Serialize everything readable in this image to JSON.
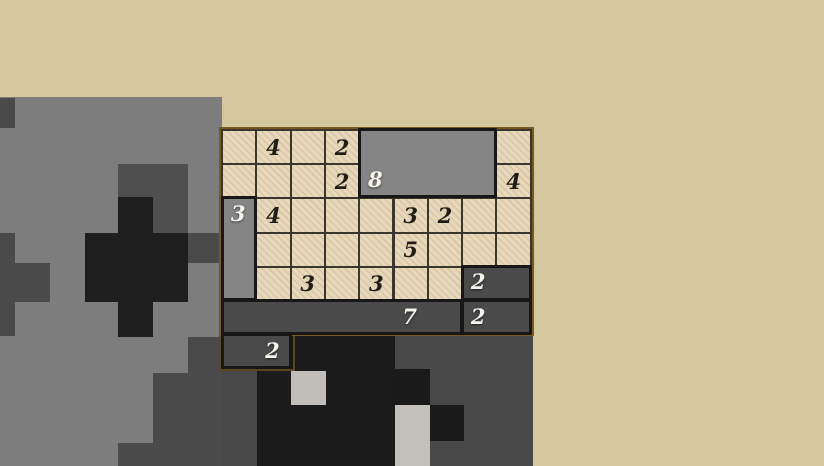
{
  "background": {
    "base_color": "#d4c7a0",
    "rects": [
      {
        "name": "terrain-gray-field",
        "x": 0,
        "y": 97,
        "w": 222,
        "h": 369,
        "color": "#7d7d7d"
      },
      {
        "name": "terrain-dark-notch-topleft",
        "x": 0,
        "y": 98,
        "w": 15,
        "h": 30,
        "color": "#4a4a4a"
      },
      {
        "name": "terrain-dark-square",
        "x": 118,
        "y": 164,
        "w": 70,
        "h": 69,
        "color": "#4f4f4f"
      },
      {
        "name": "terrain-black-vertical",
        "x": 118,
        "y": 197,
        "w": 35,
        "h": 140,
        "color": "#1e1e1e"
      },
      {
        "name": "terrain-black-horizontal",
        "x": 85,
        "y": 233,
        "w": 103,
        "h": 69,
        "color": "#1e1e1e"
      },
      {
        "name": "terrain-dark-right-nub",
        "x": 188,
        "y": 233,
        "w": 34,
        "h": 30,
        "color": "#4a4a4a"
      },
      {
        "name": "terrain-dark-left-strip",
        "x": 0,
        "y": 233,
        "w": 15,
        "h": 103,
        "color": "#4a4a4a"
      },
      {
        "name": "terrain-dark-left-arm",
        "x": 15,
        "y": 263,
        "w": 35,
        "h": 39,
        "color": "#4a4a4a"
      },
      {
        "name": "terrain-dark-under-board",
        "x": 188,
        "y": 337,
        "w": 34,
        "h": 36,
        "color": "#4a4a4a"
      },
      {
        "name": "terrain-dark-bottomleft",
        "x": 153,
        "y": 373,
        "w": 69,
        "h": 93,
        "color": "#4a4a4a"
      },
      {
        "name": "terrain-dark-bottom-step",
        "x": 118,
        "y": 443,
        "w": 35,
        "h": 23,
        "color": "#4a4a4a"
      },
      {
        "name": "bottom-dark-region",
        "x": 222,
        "y": 335,
        "w": 311,
        "h": 131,
        "color": "#484848"
      },
      {
        "name": "bottom-black-main",
        "x": 290,
        "y": 336,
        "w": 105,
        "h": 130,
        "color": "#1b1b1b"
      },
      {
        "name": "bottom-black-left",
        "x": 257,
        "y": 371,
        "w": 35,
        "h": 95,
        "color": "#1b1b1b"
      },
      {
        "name": "bottom-light-square",
        "x": 291,
        "y": 371,
        "w": 35,
        "h": 34,
        "color": "#c1bdb9"
      },
      {
        "name": "bottom-black-mid",
        "x": 395,
        "y": 369,
        "w": 35,
        "h": 36,
        "color": "#1a1a1a"
      },
      {
        "name": "bottom-light-column",
        "x": 395,
        "y": 405,
        "w": 35,
        "h": 61,
        "color": "#c3bfbb"
      },
      {
        "name": "bottom-black-right",
        "x": 430,
        "y": 405,
        "w": 34,
        "h": 36,
        "color": "#1a1a1a"
      }
    ]
  },
  "board": {
    "cols": 9,
    "rows": 6,
    "clues": [
      {
        "r": 0,
        "c": 1,
        "v": "4"
      },
      {
        "r": 0,
        "c": 3,
        "v": "2"
      },
      {
        "r": 1,
        "c": 3,
        "v": "2"
      },
      {
        "r": 1,
        "c": 8,
        "v": "4"
      },
      {
        "r": 2,
        "c": 1,
        "v": "4"
      },
      {
        "r": 2,
        "c": 5,
        "v": "3"
      },
      {
        "r": 2,
        "c": 6,
        "v": "2"
      },
      {
        "r": 3,
        "c": 5,
        "v": "5"
      },
      {
        "r": 4,
        "c": 2,
        "v": "3"
      },
      {
        "r": 4,
        "c": 4,
        "v": "3"
      }
    ],
    "blocks": [
      {
        "name": "block-8",
        "r": 0,
        "c": 4,
        "w": 4,
        "h": 2,
        "label": "8",
        "lr": 1,
        "lc": 4,
        "shade": "medium"
      },
      {
        "name": "block-3-vertical",
        "r": 2,
        "c": 0,
        "w": 1,
        "h": 3,
        "label": "3",
        "lr": 2,
        "lc": 0,
        "shade": "medium"
      },
      {
        "name": "block-2-right-upper",
        "r": 4,
        "c": 7,
        "w": 2,
        "h": 1,
        "label": "2",
        "lr": 4,
        "lc": 7,
        "shade": "dark"
      },
      {
        "name": "block-7",
        "r": 5,
        "c": 0,
        "w": 7,
        "h": 1,
        "label": "7",
        "lr": 5,
        "lc": 5,
        "shade": "dark"
      },
      {
        "name": "block-2-right-lower",
        "r": 5,
        "c": 7,
        "w": 2,
        "h": 1,
        "label": "2",
        "lr": 5,
        "lc": 7,
        "shade": "dark"
      },
      {
        "name": "block-2-bottom",
        "r": 6,
        "c": 0,
        "w": 2,
        "h": 1,
        "label": "2",
        "lr": 6,
        "lc": 1,
        "shade": "dark"
      }
    ]
  },
  "colors": {
    "cell_tan": "#e7d8bc",
    "grid_line": "#3a362e",
    "board_border_olive": "#75591f",
    "block_medium_gray": "#858585",
    "block_dark_gray": "#4a4a4a",
    "block_border": "#171717",
    "clue_text": "#211d17",
    "block_label_text": "#f6f3ec"
  }
}
